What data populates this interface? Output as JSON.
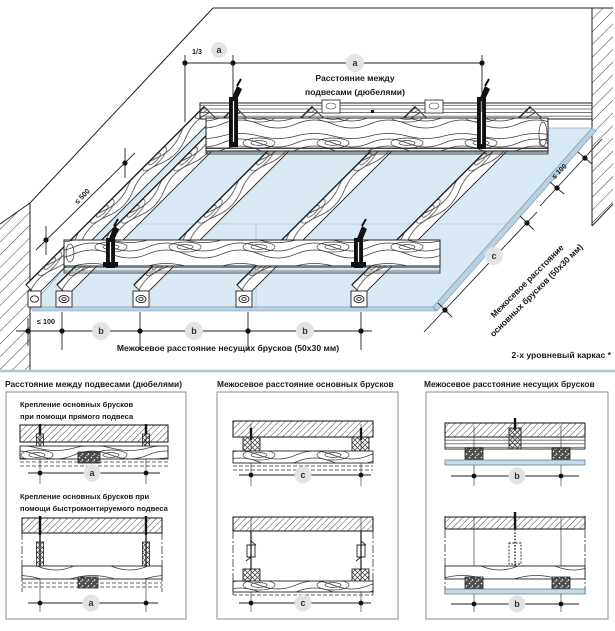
{
  "colors": {
    "panel_blue": "#d9e9f3",
    "panel_edge": "#b8d2e4",
    "board_strip": "#c2dcec",
    "separator": "#adc6d6",
    "circle_bg": "#e3e3e3",
    "line": "#222222"
  },
  "top": {
    "fraction": "1/3",
    "a": "a",
    "b": "b",
    "c": "c",
    "a_caption1": "Расстояние между",
    "a_caption2": "подвесами (дюбелями)",
    "le500": "≤ 500",
    "le100": "≤ 100",
    "b_caption": "Межосевое расстояние несущих брусков (50x30 мм)",
    "c_caption1": "Межосевое расстояние",
    "c_caption2": "основных брусков (50x30 мм)",
    "footnote": "2-х уровневый каркас *"
  },
  "panels": [
    {
      "title": "Расстояние между подвесами (дюбелями)",
      "caption1_l1": "Крепление основных брусков",
      "caption1_l2": "при помощи прямого подвеса",
      "caption2_l1": "Крепление основных брусков при",
      "caption2_l2": "помощи быстромонтируемого подвеса",
      "dim": "a"
    },
    {
      "title": "Межосевое расстояние основных брусков",
      "dim": "c"
    },
    {
      "title": "Межосевое расстояние несущих брусков",
      "dim": "b"
    }
  ]
}
